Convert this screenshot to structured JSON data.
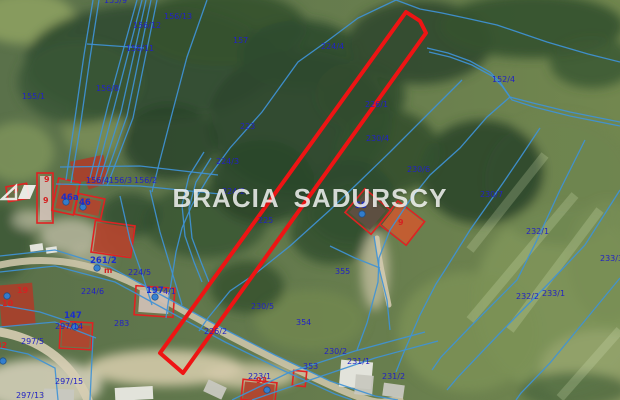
{
  "watermark": {
    "left": "BRACIA",
    "right": "SADURSCY"
  },
  "map": {
    "style": {
      "line_color": "#3f93d6",
      "label_color": "#2222c4",
      "bold_label_color": "#1b2ecc",
      "address_color": "#d42222",
      "highlight_color": "#ee1414",
      "dot_color": "#2f7fd4"
    },
    "highlight_parcel": {
      "points": "406,12 420,21 426,33 183,373 160,353"
    },
    "lines": [
      "137,0 108,105 90,178",
      "142,0 114,108 95,180",
      "146,0 121,112 99,182",
      "151,0 127,116 103,184",
      "157,0 133,118 107,186",
      "87,44 144,48",
      "93,0 84,55 74,125 66,180",
      "99,0 90,58 80,128 71,183",
      "60,167 140,166 218,175",
      "56,184 140,186 220,194",
      "207,0 187,57 173,110 160,160 152,192",
      "396,0 358,18 326,42 298,62 262,112 230,148 208,178 192,205 182,228 176,252 170,290 166,318",
      "396,0 420,9 442,13 470,19 497,25 547,42 588,54 620,62",
      "427,48 448,53 470,61 490,72 500,82 510,97 533,103 570,112 620,122",
      "429,52 450,57 472,65 492,76 502,86 512,100 534,107 570,116 620,126",
      "462,80 422,120 390,152 358,183 330,210 290,246 255,274 230,291 208,318 199,331",
      "510,97 487,117 460,148 430,175 410,200 390,230 379,258 378,282 367,323 357,350",
      "540,128 520,158 503,183 470,230 445,270 436,284 420,315 404,352 396,372",
      "585,140 560,190 537,240 517,280 470,327 441,357 432,370",
      "620,190 585,245 552,280 500,333 458,377 447,390",
      "620,278 550,363 521,393 516,400",
      "0,256 55,250 110,267 165,297 220,327 275,355 330,381 375,396 398,400",
      "0,272 55,266 115,282 170,312 225,342 280,369 335,394 352,400",
      "0,327 55,322 96,338",
      "93,336 90,400",
      "0,305 40,312 70,322",
      "232,400 290,372 355,351 425,332",
      "252,400 310,380 375,358 438,341",
      "150,190 160,232 172,272 182,305",
      "120,196 130,240 143,277 152,305",
      "204,152 189,176 182,205 185,236 194,262 202,282",
      "211,158 196,182 189,208 192,238 201,262 209,282",
      "374,236 379,268 387,300 390,330",
      "330,246 355,258 380,268",
      "0,348 28,354 55,368 58,400"
    ],
    "roads": [
      {
        "d": "M0,265 C60,252 110,268 165,300 S270,358 330,385 S380,399 400,400",
        "w": 7,
        "color": "#ccc4a9"
      },
      {
        "d": "M0,332 C35,338 70,358 88,400",
        "w": 9,
        "color": "#d6cdb3"
      },
      {
        "d": "M377,238 C379,260 384,280 389,305",
        "w": 5,
        "color": "#d2c9ae"
      }
    ],
    "buildings": [
      {
        "x": 72,
        "y": 158,
        "w": 34,
        "h": 22,
        "r": -12,
        "t": "red"
      },
      {
        "x": 86,
        "y": 174,
        "w": 18,
        "h": 13,
        "r": -20,
        "t": "red"
      },
      {
        "x": 40,
        "y": 176,
        "w": 11,
        "h": 44,
        "r": 0,
        "t": "grey"
      },
      {
        "x": 37,
        "y": 173,
        "w": 16,
        "h": 50,
        "r": 0,
        "t": "outline"
      },
      {
        "x": 7,
        "y": 185,
        "w": 21,
        "h": 15,
        "r": -10,
        "t": "outline"
      },
      {
        "x": 58,
        "y": 184,
        "w": 16,
        "h": 26,
        "r": 12,
        "t": "red"
      },
      {
        "x": 55,
        "y": 180,
        "w": 22,
        "h": 33,
        "r": 12,
        "t": "outline"
      },
      {
        "x": 79,
        "y": 199,
        "w": 21,
        "h": 15,
        "r": 12,
        "t": "red"
      },
      {
        "x": 76,
        "y": 196,
        "w": 27,
        "h": 21,
        "r": 12,
        "t": "outline"
      },
      {
        "x": 95,
        "y": 225,
        "w": 37,
        "h": 29,
        "r": 8,
        "t": "red"
      },
      {
        "x": 93,
        "y": 223,
        "w": 40,
        "h": 32,
        "r": 8,
        "t": "outline"
      },
      {
        "x": 139,
        "y": 291,
        "w": 30,
        "h": 22,
        "r": 4,
        "t": "grey"
      },
      {
        "x": 135,
        "y": 287,
        "w": 39,
        "h": 29,
        "r": 4,
        "t": "outline"
      },
      {
        "x": 62,
        "y": 325,
        "w": 28,
        "h": 22,
        "r": 3,
        "t": "red"
      },
      {
        "x": 60,
        "y": 322,
        "w": 32,
        "h": 27,
        "r": 3,
        "t": "outline"
      },
      {
        "x": 0,
        "y": 284,
        "w": 34,
        "h": 42,
        "r": -5,
        "t": "red"
      },
      {
        "x": 244,
        "y": 383,
        "w": 30,
        "h": 17,
        "r": 6,
        "t": "red"
      },
      {
        "x": 242,
        "y": 381,
        "w": 34,
        "h": 20,
        "r": 6,
        "t": "outline"
      },
      {
        "x": 293,
        "y": 371,
        "w": 13,
        "h": 15,
        "r": 6,
        "t": "outline"
      },
      {
        "x": 354,
        "y": 199,
        "w": 27,
        "h": 25,
        "r": 40,
        "t": "dark"
      },
      {
        "x": 351,
        "y": 196,
        "w": 34,
        "h": 31,
        "r": 40,
        "t": "outline"
      },
      {
        "x": 387,
        "y": 210,
        "w": 31,
        "h": 27,
        "r": 38,
        "t": "orange"
      },
      {
        "x": 385,
        "y": 208,
        "w": 34,
        "h": 30,
        "r": 38,
        "t": "outline"
      },
      {
        "x": 340,
        "y": 361,
        "w": 32,
        "h": 27,
        "r": 5,
        "t": "white"
      },
      {
        "x": 383,
        "y": 384,
        "w": 21,
        "h": 13,
        "r": 8,
        "t": "grey"
      },
      {
        "x": 44,
        "y": 389,
        "w": 30,
        "h": 12,
        "r": 2,
        "t": "grey"
      },
      {
        "x": 115,
        "y": 387,
        "w": 38,
        "h": 13,
        "r": -3,
        "t": "white"
      },
      {
        "x": 205,
        "y": 383,
        "w": 20,
        "h": 13,
        "r": 25,
        "t": "grey"
      },
      {
        "x": 355,
        "y": 375,
        "w": 18,
        "h": 20,
        "r": 5,
        "t": "grey"
      },
      {
        "x": 30,
        "y": 244,
        "w": 13,
        "h": 7,
        "r": -8,
        "t": "white"
      },
      {
        "x": 46,
        "y": 247,
        "w": 11,
        "h": 6,
        "r": -8,
        "t": "white"
      }
    ],
    "address_points": [
      [
        362,
        214
      ],
      [
        75,
        327
      ],
      [
        97,
        268
      ],
      [
        66,
        202
      ],
      [
        83,
        207
      ],
      [
        267,
        390
      ],
      [
        3,
        361
      ],
      [
        7,
        296
      ],
      [
        155,
        297
      ]
    ],
    "labels": [
      {
        "t": "155/9",
        "x": 104,
        "y": -4,
        "c": "p"
      },
      {
        "t": "156/13",
        "x": 164,
        "y": 12,
        "c": "p"
      },
      {
        "t": "156/12",
        "x": 133,
        "y": 21,
        "c": "p"
      },
      {
        "t": "156/11",
        "x": 126,
        "y": 44,
        "c": "p"
      },
      {
        "t": "157",
        "x": 233,
        "y": 36,
        "c": "p"
      },
      {
        "t": "156/8",
        "x": 96,
        "y": 84,
        "c": "p"
      },
      {
        "t": "155/1",
        "x": 22,
        "y": 92,
        "c": "p"
      },
      {
        "t": "223",
        "x": 240,
        "y": 122,
        "c": "p"
      },
      {
        "t": "224/4",
        "x": 321,
        "y": 42,
        "c": "p"
      },
      {
        "t": "152/4",
        "x": 492,
        "y": 75,
        "c": "p"
      },
      {
        "t": "226/1",
        "x": 365,
        "y": 100,
        "c": "p"
      },
      {
        "t": "230/4",
        "x": 366,
        "y": 134,
        "c": "p"
      },
      {
        "t": "230/6",
        "x": 407,
        "y": 165,
        "c": "p"
      },
      {
        "t": "230/7",
        "x": 480,
        "y": 190,
        "c": "p"
      },
      {
        "t": "224/3",
        "x": 216,
        "y": 157,
        "c": "p"
      },
      {
        "t": "224/2",
        "x": 222,
        "y": 187,
        "c": "p"
      },
      {
        "t": "156/4",
        "x": 86,
        "y": 176,
        "c": "p"
      },
      {
        "t": "156/3",
        "x": 109,
        "y": 176,
        "c": "p"
      },
      {
        "t": "156/2",
        "x": 134,
        "y": 176,
        "c": "p"
      },
      {
        "t": "225",
        "x": 258,
        "y": 216,
        "c": "p"
      },
      {
        "t": "232/1",
        "x": 526,
        "y": 227,
        "c": "p"
      },
      {
        "t": "233/3",
        "x": 600,
        "y": 254,
        "c": "p"
      },
      {
        "t": "232/2",
        "x": 516,
        "y": 292,
        "c": "p"
      },
      {
        "t": "233/1",
        "x": 542,
        "y": 289,
        "c": "p"
      },
      {
        "t": "230/5",
        "x": 251,
        "y": 302,
        "c": "p"
      },
      {
        "t": "226/2",
        "x": 204,
        "y": 327,
        "c": "p"
      },
      {
        "t": "354",
        "x": 296,
        "y": 318,
        "c": "p"
      },
      {
        "t": "355",
        "x": 335,
        "y": 267,
        "c": "p"
      },
      {
        "t": "230/2",
        "x": 324,
        "y": 347,
        "c": "p"
      },
      {
        "t": "231/1",
        "x": 347,
        "y": 357,
        "c": "p"
      },
      {
        "t": "353",
        "x": 303,
        "y": 362,
        "c": "p"
      },
      {
        "t": "231/2",
        "x": 382,
        "y": 372,
        "c": "p"
      },
      {
        "t": "224/5",
        "x": 128,
        "y": 268,
        "c": "p"
      },
      {
        "t": "224/6",
        "x": 81,
        "y": 287,
        "c": "p"
      },
      {
        "t": "283",
        "x": 114,
        "y": 319,
        "c": "p"
      },
      {
        "t": "297/5",
        "x": 21,
        "y": 337,
        "c": "p"
      },
      {
        "t": "297/15",
        "x": 55,
        "y": 377,
        "c": "p"
      },
      {
        "t": "297/13",
        "x": 16,
        "y": 391,
        "c": "p"
      },
      {
        "t": "297/14",
        "x": 55,
        "y": 322,
        "c": "p"
      },
      {
        "t": "223/1",
        "x": 248,
        "y": 372,
        "c": "p"
      },
      {
        "t": "4/1",
        "x": 163,
        "y": 287,
        "c": "p"
      },
      {
        "t": "58",
        "x": 355,
        "y": 201,
        "c": "b"
      },
      {
        "t": "46a",
        "x": 61,
        "y": 193,
        "c": "b"
      },
      {
        "t": "46",
        "x": 79,
        "y": 198,
        "c": "b"
      },
      {
        "t": "147",
        "x": 64,
        "y": 311,
        "c": "b"
      },
      {
        "t": "197",
        "x": 146,
        "y": 286,
        "c": "b"
      },
      {
        "t": "261/2",
        "x": 90,
        "y": 256,
        "c": "b"
      },
      {
        "t": "9",
        "x": 44,
        "y": 175,
        "c": "r"
      },
      {
        "t": "9",
        "x": 43,
        "y": 196,
        "c": "r"
      },
      {
        "t": "9",
        "x": 13,
        "y": 186,
        "c": "r"
      },
      {
        "t": "9",
        "x": 398,
        "y": 218,
        "c": "r"
      },
      {
        "t": "m",
        "x": 104,
        "y": 266,
        "c": "r"
      },
      {
        "t": "19",
        "x": 17,
        "y": 286,
        "c": "r"
      },
      {
        "t": "10",
        "x": 2,
        "y": 299,
        "c": "r"
      },
      {
        "t": "93",
        "x": 256,
        "y": 376,
        "c": "r"
      },
      {
        "t": "82",
        "x": -4,
        "y": 341,
        "c": "r"
      }
    ]
  }
}
